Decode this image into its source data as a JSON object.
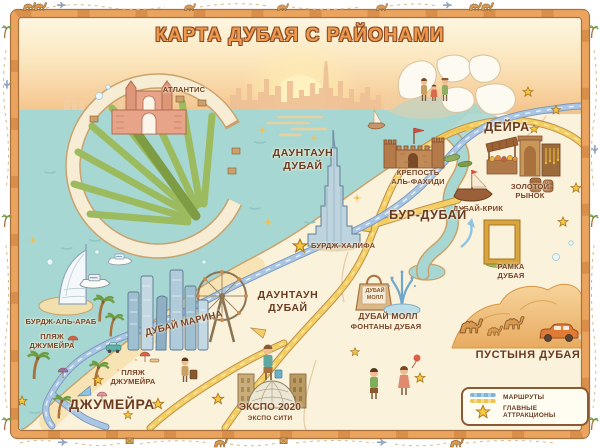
{
  "title": "КАРТА ДУБАЯ С РАЙОНАМИ",
  "districts": {
    "deira": "ДЕЙРА",
    "bur_dubai": "БУР-ДУБАЙ",
    "downtown_1": "ДАУНТАУН ДУБАЙ",
    "downtown_2": "ДАУНТАУН ДУБАЙ",
    "jumeirah": "ДЖУМЕЙРА",
    "desert": "ПУСТЫНЯ ДУБАЯ"
  },
  "attractions": {
    "atlantis": "АТЛАНТИС",
    "al_fahidi_fort": "КРЕПОСТЬ АЛЬ-ФАХИДИ",
    "gold_market": "ЗОЛОТОЙ РЫНОК",
    "dubai_creek": "ДУБАЙ-КРИК",
    "burj_khalifa": "БУРДЖ-ХАЛИФА",
    "dubai_frame": "РАМКА ДУБАЯ",
    "burj_al_arab": "БУРДЖ-АЛЬ-АРАБ",
    "jumeirah_beach_1": "ПЛЯЖ ДЖУМЕЙРА",
    "dubai_marina": "ДУБАЙ МАРИНА",
    "dubai_mall": "ДУБАЙ МОЛЛ",
    "dubai_fountains": "ФОНТАНЫ ДУБАЯ",
    "jumeirah_beach_2": "ПЛЯЖ ДЖУМЕЙРА",
    "expo_2020": "ЭКСПО 2020",
    "expo_city": "ЭКСПО СИТИ",
    "mall_bag_text": "ДУБАЙ МОЛЛ"
  },
  "legend": {
    "routes_label": "МАРШРУТЫ",
    "attractions_label": "ГЛАВНЫЕ АТТРАКЦИОНЫ"
  },
  "colors": {
    "sea": "#a7d7d2",
    "land": "#fbf2dc",
    "sand": "#f7e3b4",
    "road_yellow": "#f3cf63",
    "road_blue": "#a9c6e5",
    "star_yellow": "#f6c83e",
    "label_brown": "#6b3a1f",
    "title_orange": "#ed9a4e",
    "frame_orange": "#eaa45e"
  }
}
